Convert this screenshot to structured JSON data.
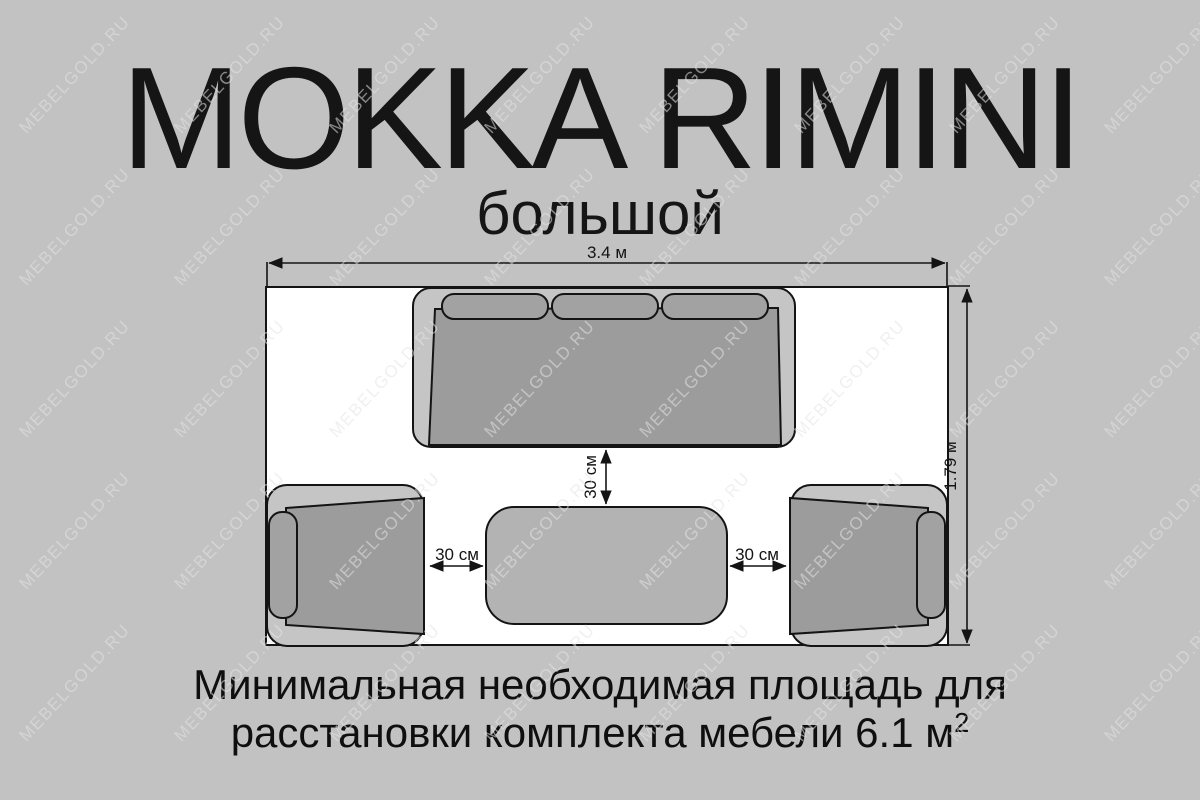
{
  "title": "MOKKA RIMINI",
  "subtitle": "большой",
  "watermark": {
    "text": "MEBELGOLD.RU"
  },
  "diagram": {
    "room_width_label": "3.4 м",
    "room_height_label": "1.79 м",
    "sofa_to_table_gap_label": "30 см",
    "left_chair_to_table_gap_label": "30 см",
    "right_chair_to_table_gap_label": "30 см",
    "furniture": [
      "sofa",
      "armchair-left",
      "armchair-right",
      "coffee-table"
    ]
  },
  "footer": {
    "line1": "Минимальная необходимая площадь для",
    "line2": "расстановки комплекта мебели 6.1 м",
    "line2_superscript": "2"
  },
  "colors": {
    "background": "#c2c2c2",
    "room_fill": "#ffffff",
    "outline": "#141414",
    "furniture_frame": "#c5c5c5",
    "furniture_seat": "#9c9c9c",
    "furniture_cushion": "#a2a2a2",
    "table_fill": "#b3b3b3"
  }
}
